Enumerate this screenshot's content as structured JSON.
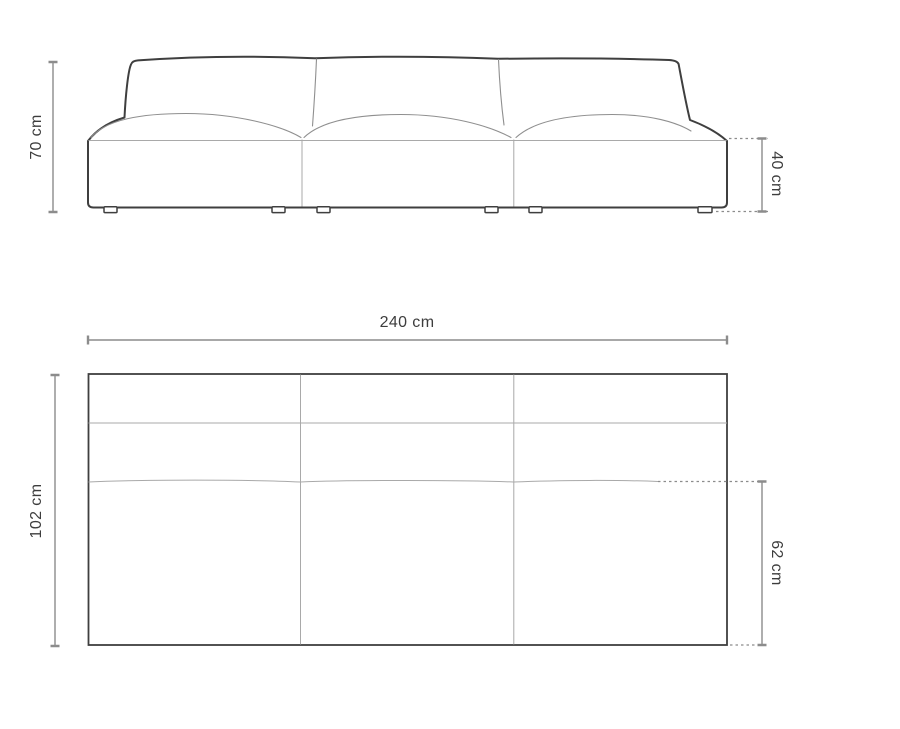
{
  "diagram": {
    "subject": "modular-armless-sofa-dimensions",
    "front_view": {
      "modules": 3,
      "height_label": "70 cm",
      "seat_height_label": "40 cm"
    },
    "top_view": {
      "modules": 3,
      "width_label": "240 cm",
      "depth_label": "102 cm",
      "seat_depth_label": "62 cm"
    }
  },
  "colors": {
    "background": "#ffffff",
    "outline": "#3f3f3f",
    "seam_line": "#8f8f8f",
    "dimension_line": "#8c8c8c",
    "label_text": "#3d3d3d"
  }
}
